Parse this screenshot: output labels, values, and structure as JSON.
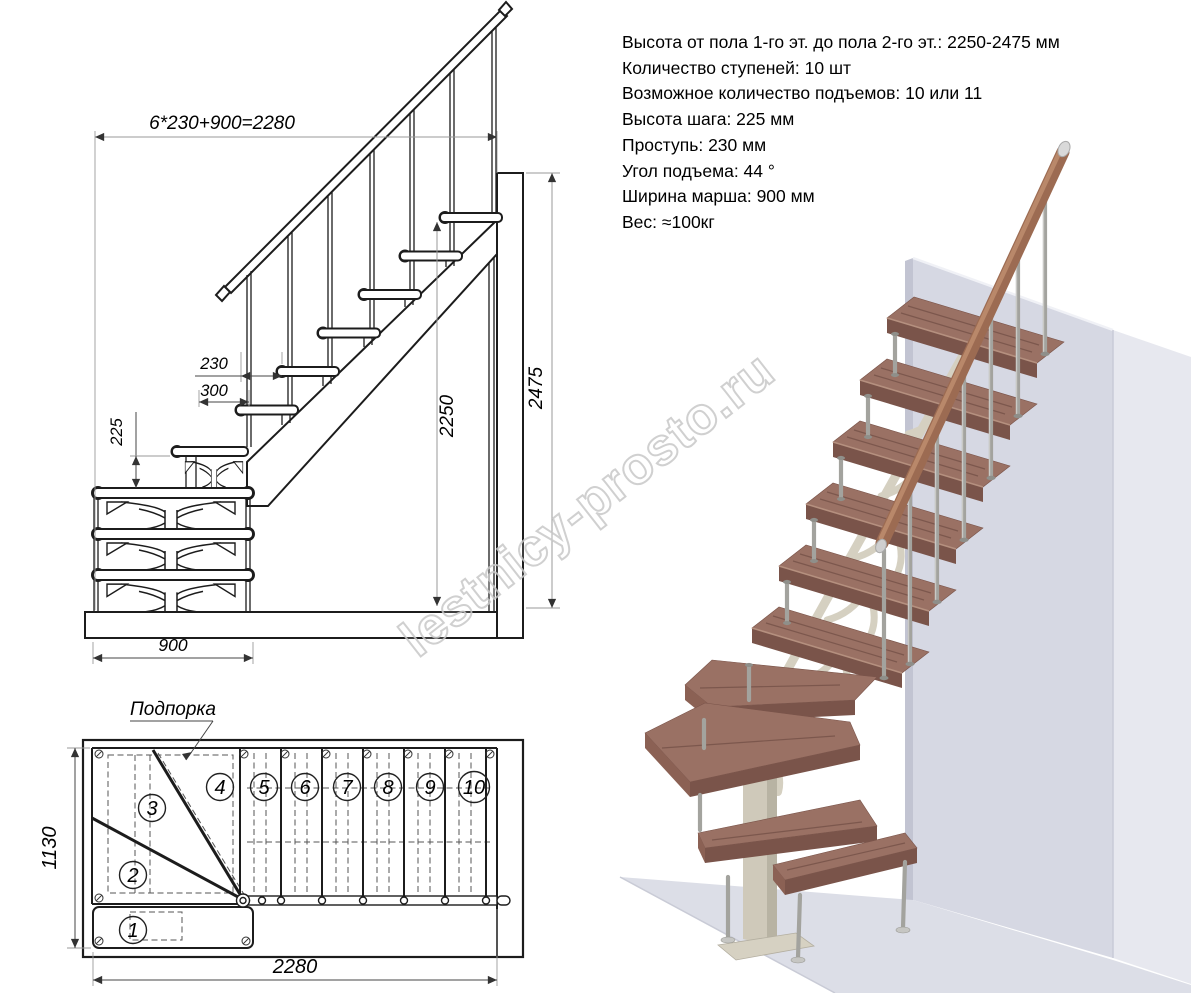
{
  "watermark": {
    "text": "lestnicy-prosto.ru"
  },
  "specs": {
    "lines": [
      "Высота от пола 1-го эт. до пола 2-го эт.: 2250-2475 мм",
      "Количество ступеней: 10 шт",
      "Возможное количество подъемов: 10 или 11",
      "Высота шага: 225 мм",
      "Проступь: 230 мм",
      "Угол подъема: 44 °",
      "Ширина марша: 900 мм",
      "Вес: ≈100кг"
    ]
  },
  "elevation": {
    "dims": {
      "total_run": "6*230+900=2280",
      "tread_depth": "230",
      "tread_width": "300",
      "riser_height": "225",
      "clear_height": "2250",
      "total_height": "2475",
      "march_width": "900"
    }
  },
  "plan": {
    "support_label": "Подпорка",
    "dims": {
      "depth": "1130",
      "length": "2280"
    },
    "steps": [
      "1",
      "2",
      "3",
      "4",
      "5",
      "6",
      "7",
      "8",
      "9",
      "10"
    ]
  },
  "render3d": {
    "colors": {
      "wall_front": "#d6d8e3",
      "wall_side": "#e7e8ef",
      "floor": "#dcdee7",
      "tread_top": "#9a7164",
      "tread_front": "#7a544a",
      "tread_side": "#8b6154",
      "handrail": "#9c6b52",
      "baluster": "#a3a39e",
      "support": "#cfc9ba"
    }
  }
}
